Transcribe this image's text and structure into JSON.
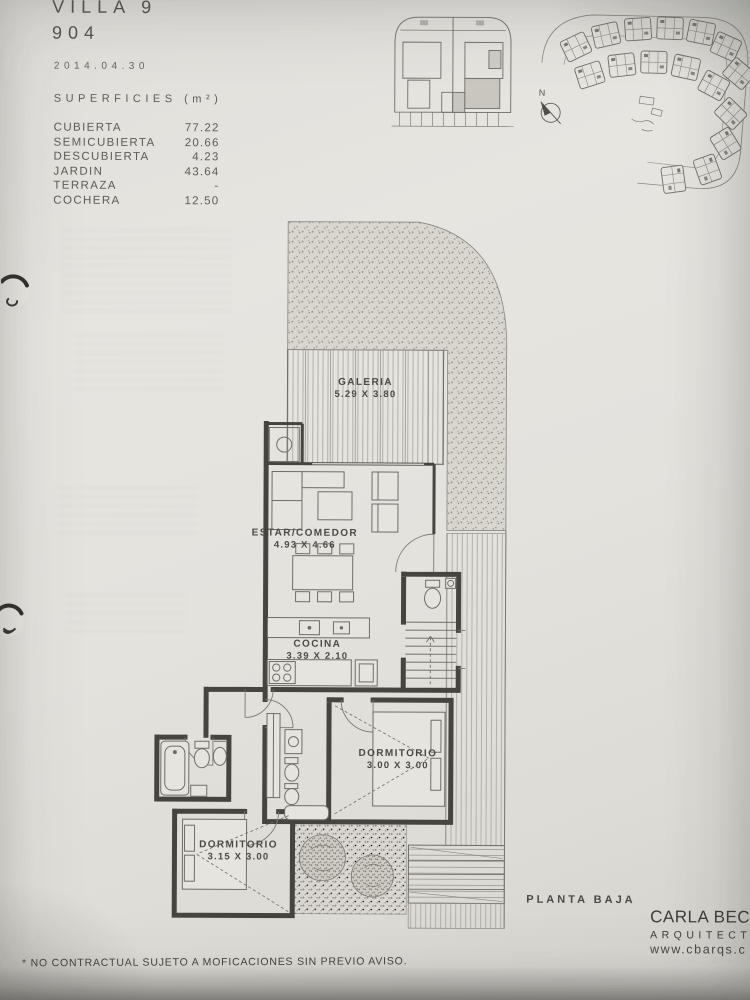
{
  "meta": {
    "sheet_title": "VILLA 9",
    "sheet_number": "904",
    "date": "2014.04.30"
  },
  "superficies": {
    "title": "SUPERFICIES (m²)",
    "rows": [
      {
        "label": "CUBIERTA",
        "value": "77.22"
      },
      {
        "label": "SEMICUBIERTA",
        "value": "20.66"
      },
      {
        "label": "DESCUBIERTA",
        "value": "4.23"
      },
      {
        "label": "JARDIN",
        "value": "43.64"
      },
      {
        "label": "TERRAZA",
        "value": "-"
      },
      {
        "label": "COCHERA",
        "value": "12.50"
      }
    ]
  },
  "site_plan": {
    "north_label": "N"
  },
  "rooms": {
    "galeria": {
      "name": "GALERIA",
      "dims": "5.29 X 3.80"
    },
    "estar_comedor": {
      "name": "ESTAR/COMEDOR",
      "dims": "4.93 X 4.66"
    },
    "cocina": {
      "name": "COCINA",
      "dims": "3.39 X 2.10"
    },
    "dormitorio_1": {
      "name": "DORMITORIO",
      "dims": "3.00 X 3.00"
    },
    "dormitorio_2": {
      "name": "DORMITORIO",
      "dims": "3.15 X 3.00"
    }
  },
  "plan_title": "PLANTA BAJA",
  "architect": {
    "name": "CARLA BECHE",
    "role": "ARQUITECT",
    "website": "www.cbarqs.c"
  },
  "footer_note": "* NO CONTRACTUAL SUJETO A MOFICACIONES SIN PREVIO AVISO.",
  "colors": {
    "paper": "#e4e2dd",
    "ink": "#46443f",
    "thin_line": "#6f6d67",
    "hatch": "#8c8983"
  }
}
